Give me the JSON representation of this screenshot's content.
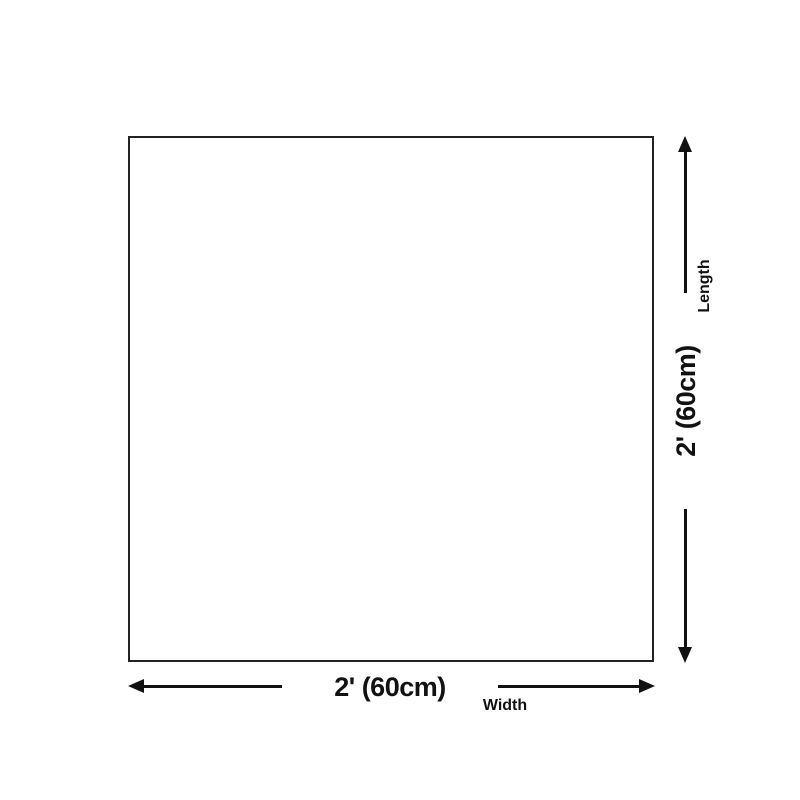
{
  "page": {
    "background_color": "#ffffff",
    "line_color": "#111111",
    "box_border_color": "#222222"
  },
  "diagram": {
    "type": "product-size-diagram",
    "shape": "square",
    "dimensions": {
      "width": {
        "value": "2' (60cm)",
        "label": "Width"
      },
      "length": {
        "value": "2' (60cm)",
        "label": "Length"
      }
    }
  }
}
